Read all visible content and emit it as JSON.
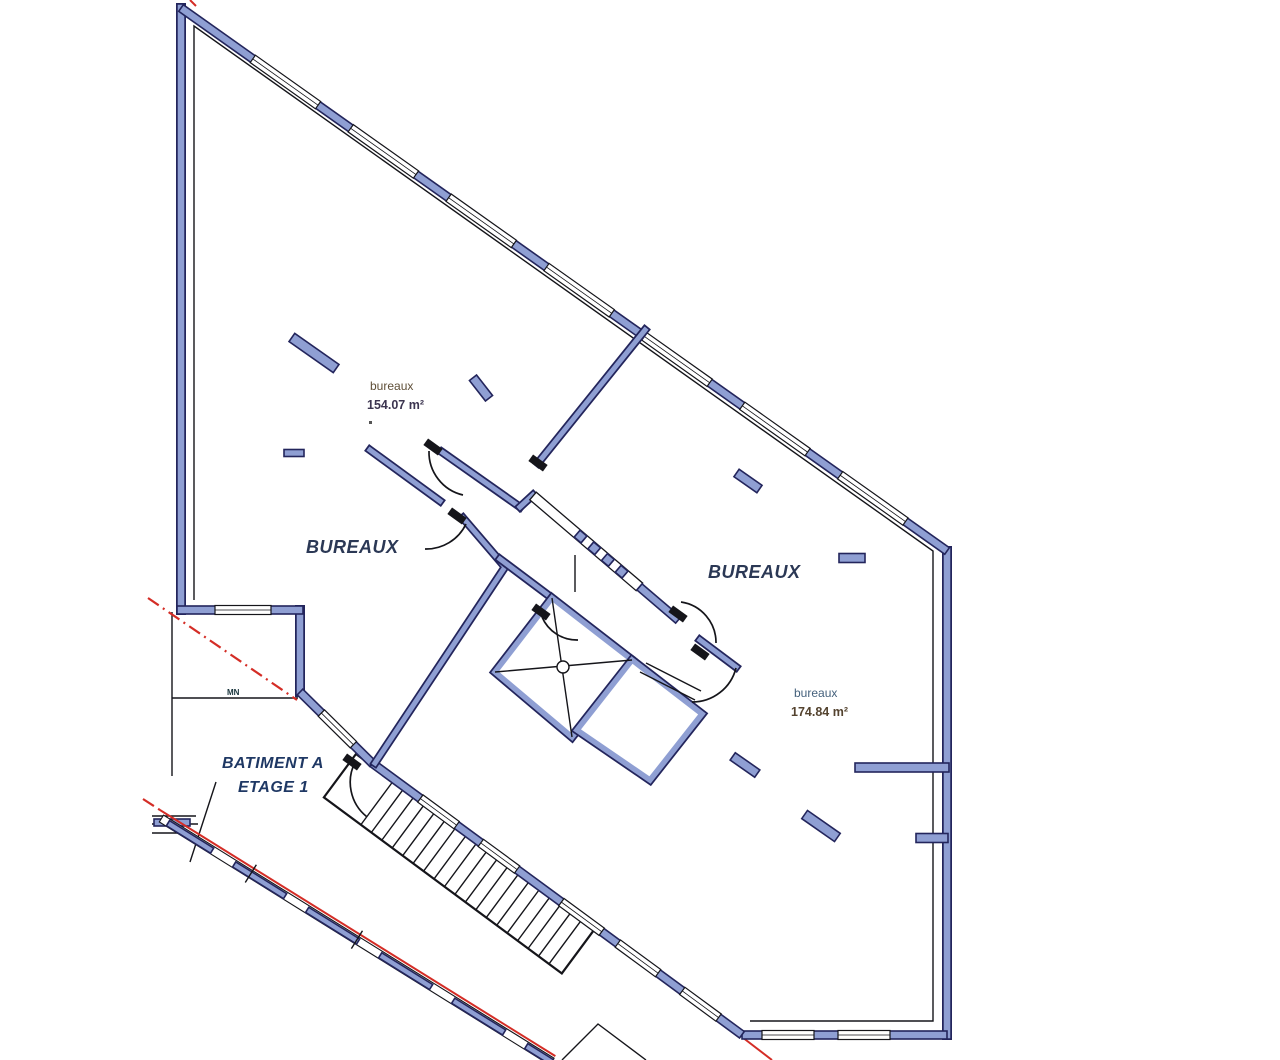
{
  "plan": {
    "building": {
      "line1": "BATIMENT A",
      "line2": "ETAGE 1"
    },
    "rooms": [
      {
        "name": "bureaux",
        "area": "154.07 m²"
      },
      {
        "name": "BUREAUX",
        "area": ""
      },
      {
        "name": "BUREAUX",
        "area": ""
      },
      {
        "name": "bureaux",
        "area": "174.84 m²"
      }
    ],
    "marks": {
      "boundary": "MN"
    },
    "colors": {
      "wall_fill": "#8f9fd3",
      "wall_edge": "#23255c",
      "drawing_line": "#15151a",
      "boundary_red": "#d42d26"
    }
  }
}
